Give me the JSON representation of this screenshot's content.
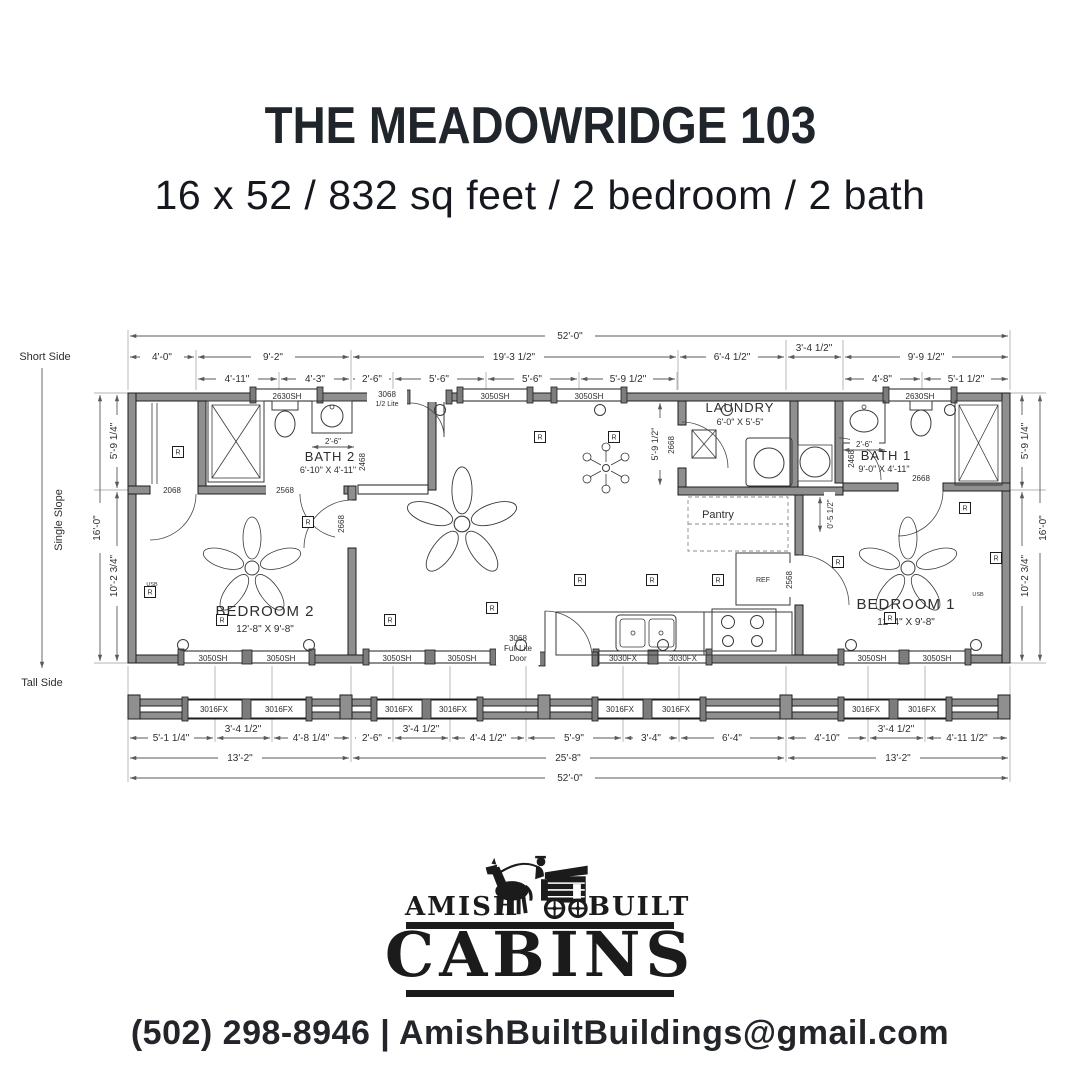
{
  "header": {
    "title": "THE MEADOWRIDGE 103",
    "subtitle": "16 x 52 / 832 sq feet / 2 bedroom / 2 bath"
  },
  "side": {
    "short": "Short Side",
    "slope": "Single Slope",
    "tall": "Tall Side"
  },
  "dims": {
    "top_overall": "52'-0\"",
    "top_row2": [
      "4'-0\"",
      "9'-2\"",
      "19'-3 1/2\"",
      "6'-4 1/2\"",
      "3'-4 1/2\"",
      "9'-9 1/2\""
    ],
    "top_row3": [
      "4'-11\"",
      "4'-3\"",
      "2'-6\"",
      "5'-6\"",
      "5'-6\"",
      "5'-9 1/2\"",
      "4'-8\"",
      "5'-1 1/2\""
    ],
    "left": {
      "overall": "16'-0\"",
      "upper": "5'-9 1/4\"",
      "lower": "10'-2 3/4\""
    },
    "right": {
      "overall": "16'-0\"",
      "upper": "5'-9 1/4\"",
      "lower": "10'-2 3/4\""
    },
    "bottom_row1": [
      "5'-1 1/4\"",
      "3'-4 1/2\"",
      "4'-8 1/4\"",
      "2'-6\"",
      "3'-4 1/2\"",
      "4'-4 1/2\"",
      "5'-9\"",
      "3'-4\"",
      "6'-4\"",
      "4'-10\"",
      "3'-4 1/2\"",
      "4'-11 1/2\""
    ],
    "bottom_row2": [
      "13'-2\"",
      "25'-8\"",
      "13'-2\""
    ],
    "bottom_overall": "52'-0\"",
    "bath2_clear": "2'-6\"",
    "bath1_clear": "2'-6\"",
    "laundry_depth": "5'-9 1/2\"",
    "kitchen_offset": "0'-5 1/2\""
  },
  "rooms": {
    "bedroom2": {
      "name": "BEDROOM 2",
      "size": "12'-8\" X 9'-8\""
    },
    "bedroom1": {
      "name": "BEDROOM 1",
      "size": "12'-4\" X 9'-8\""
    },
    "bath2": {
      "name": "BATH 2",
      "size": "6'-10\" X 4'-11\""
    },
    "bath1": {
      "name": "BATH 1",
      "size": "9'-0\" X 4'-11\""
    },
    "laundry": {
      "name": "LAUNDRY",
      "size": "6'-0\" X 5'-5\""
    },
    "pantry": "Pantry",
    "ref": "REF"
  },
  "openings": {
    "top": [
      "2630SH",
      "3050SH",
      "3050SH",
      "2630SH"
    ],
    "front_door": [
      "3068",
      "1/2 Lite"
    ],
    "bottom": [
      "3050SH",
      "3050SH",
      "3050SH",
      "3050SH",
      "3030FX",
      "3030FX",
      "3050SH",
      "3050SH"
    ],
    "back_door": [
      "3068",
      "Full Lite",
      "Door"
    ],
    "porch": [
      "3016FX",
      "3016FX",
      "3016FX",
      "3016FX",
      "3016FX",
      "3016FX",
      "3016FX",
      "3016FX"
    ],
    "doors": {
      "closet2": "2068",
      "bath2_hall": "2568",
      "bath2": "2468",
      "bedroom2": "2668",
      "laundry": "2668",
      "bath1": "2468",
      "bath1_bed": "2668",
      "bedroom1": "2568"
    }
  },
  "symbols": {
    "receptacle": "R",
    "usb": "USB"
  },
  "logo": {
    "word1": "AMISH",
    "word2": "BUILT",
    "word3": "CABINS"
  },
  "contact": {
    "line": "(502) 298-8946 | AmishBuiltBuildings@gmail.com"
  }
}
